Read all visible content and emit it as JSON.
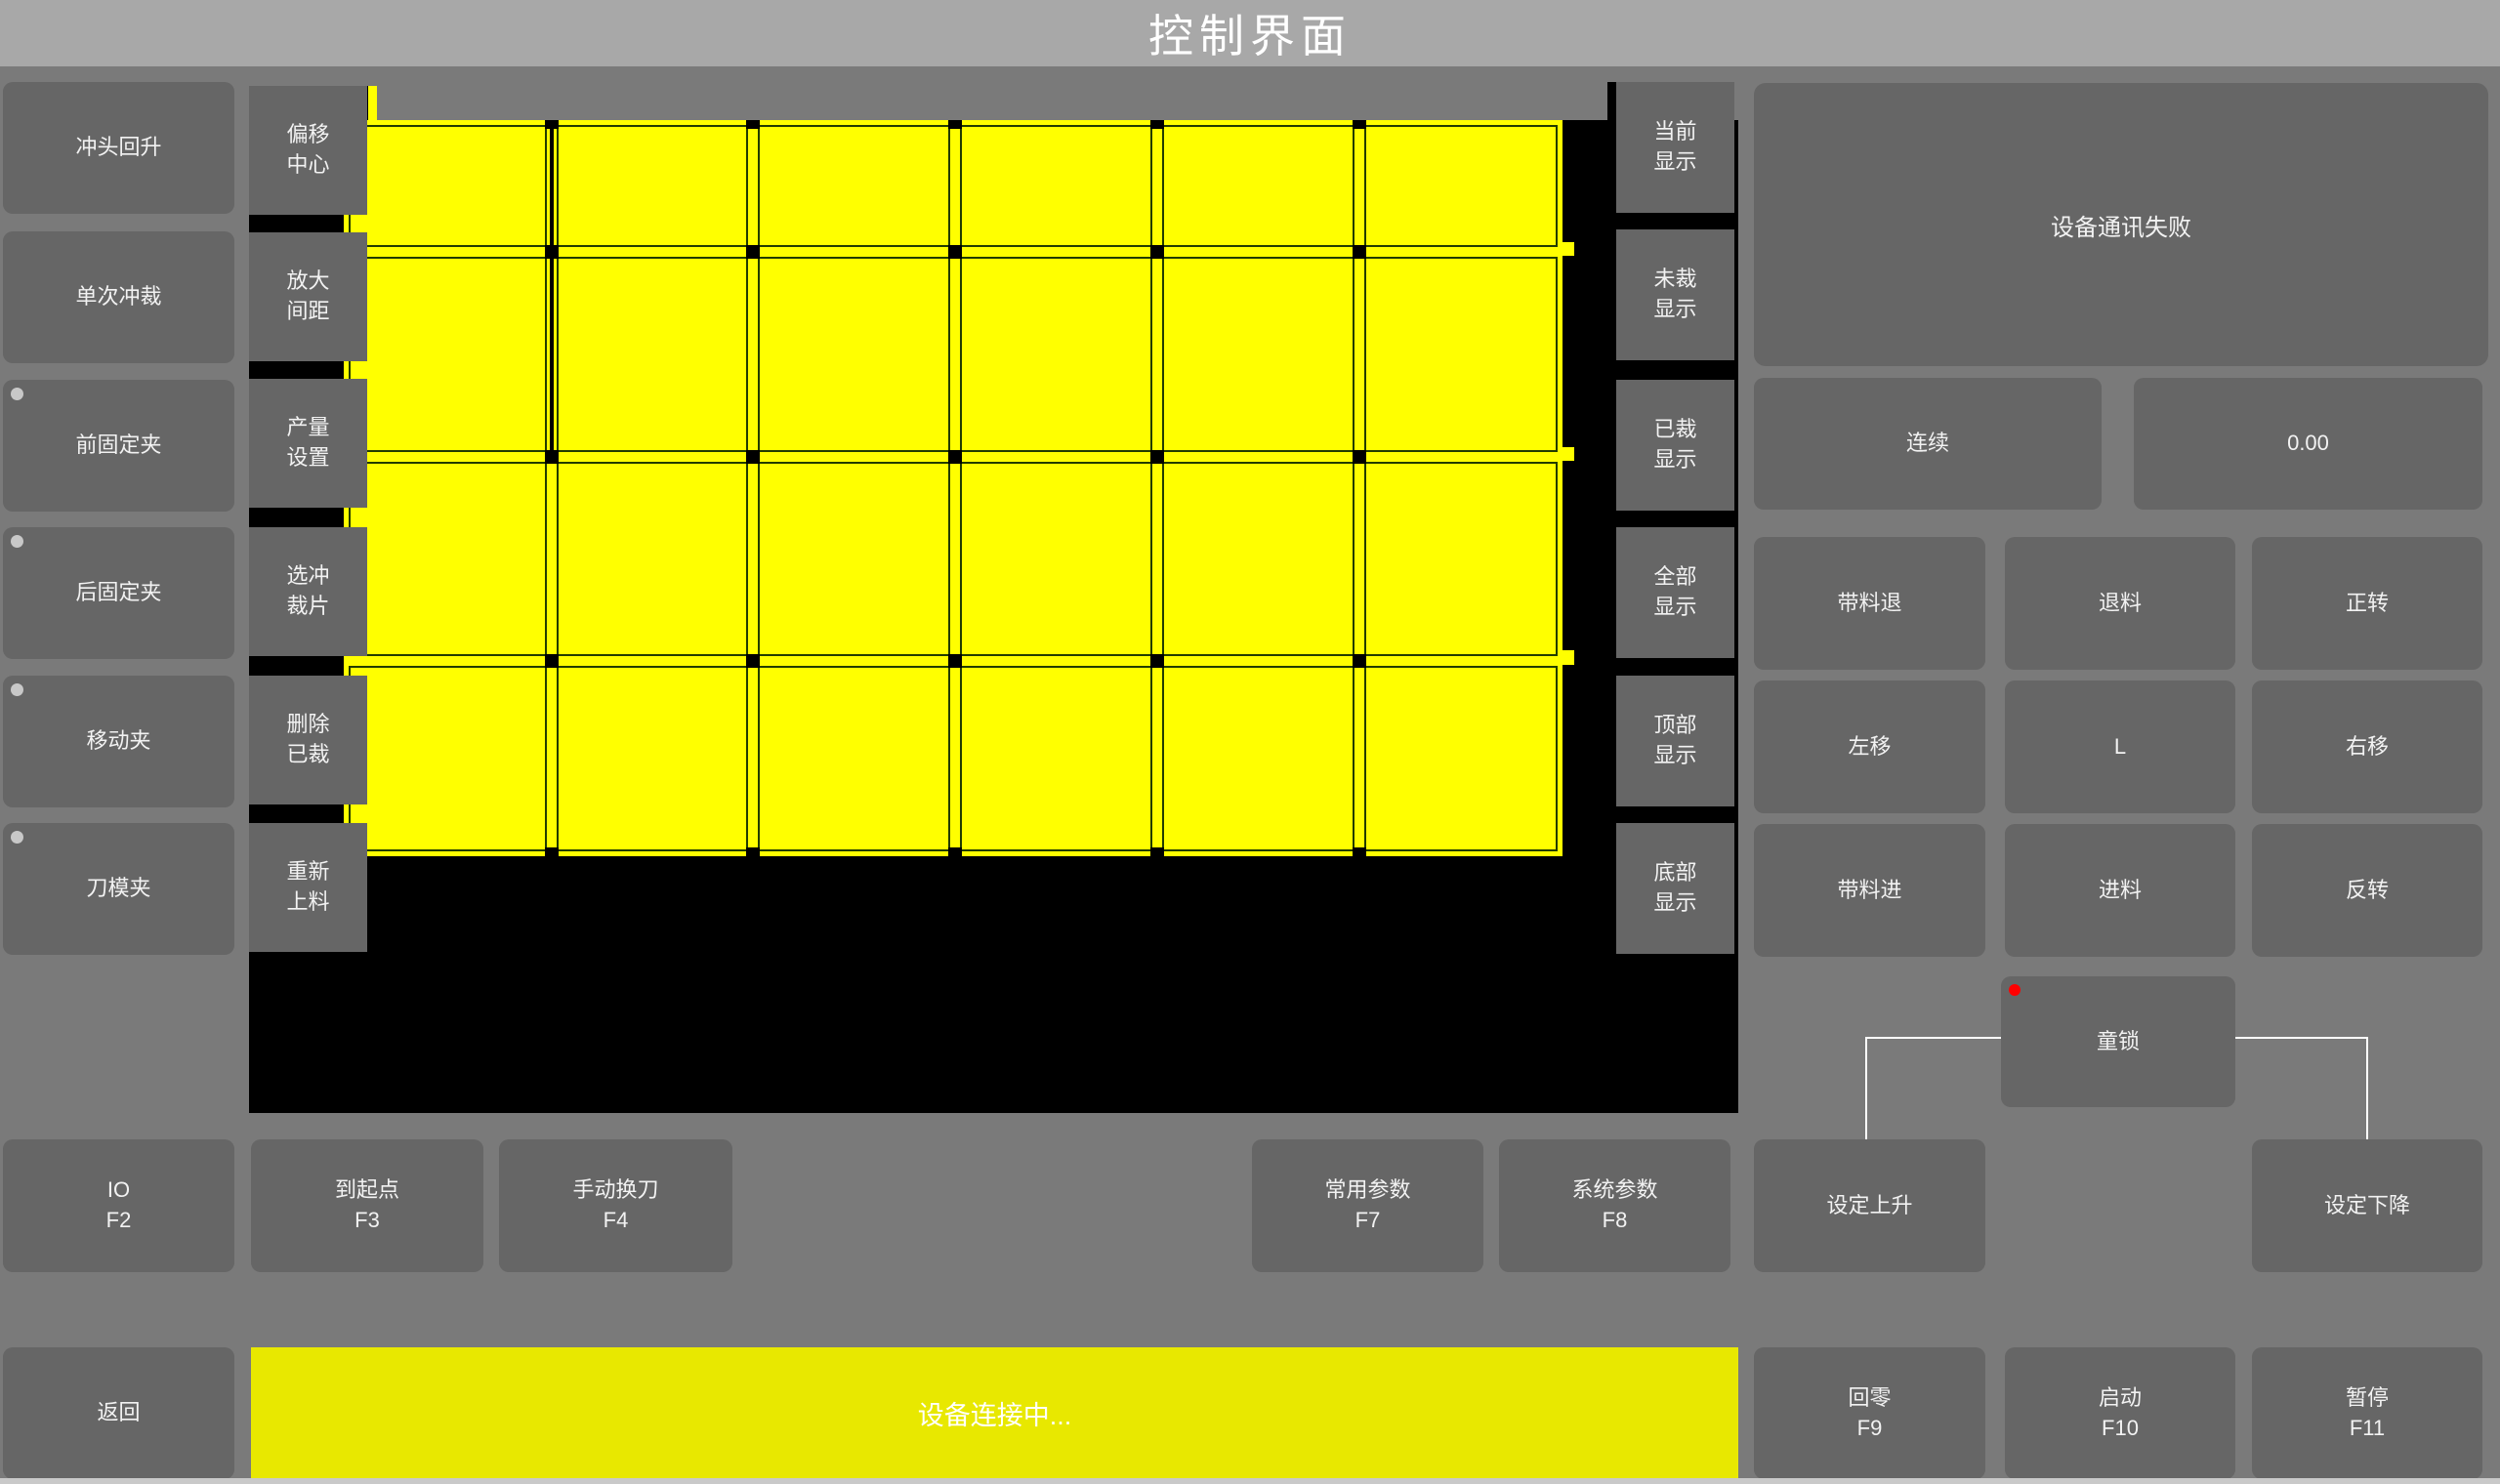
{
  "title": "控制界面",
  "machine_buttons": [
    {
      "name": "punch-up",
      "label": "冲头回升",
      "indicator": false
    },
    {
      "name": "single-punch",
      "label": "单次冲裁",
      "indicator": false
    },
    {
      "name": "front-clamp",
      "label": "前固定夹",
      "indicator": true
    },
    {
      "name": "rear-clamp",
      "label": "后固定夹",
      "indicator": true
    },
    {
      "name": "moving-clamp",
      "label": "移动夹",
      "indicator": true
    },
    {
      "name": "die-clamp",
      "label": "刀模夹",
      "indicator": true
    }
  ],
  "tool_buttons": [
    {
      "name": "offset-center",
      "label": "偏移\n中心"
    },
    {
      "name": "enlarge-spacing",
      "label": "放大\n间距"
    },
    {
      "name": "output-settings",
      "label": "产量\n设置"
    },
    {
      "name": "select-piece",
      "label": "选冲\n裁片"
    },
    {
      "name": "delete-cut",
      "label": "删除\n已裁"
    },
    {
      "name": "reload-material",
      "label": "重新\n上料"
    }
  ],
  "view_buttons": [
    {
      "name": "view-current",
      "label": "当前\n显示"
    },
    {
      "name": "view-uncut",
      "label": "未裁\n显示"
    },
    {
      "name": "view-cut",
      "label": "已裁\n显示"
    },
    {
      "name": "view-all",
      "label": "全部\n显示"
    },
    {
      "name": "view-top",
      "label": "顶部\n显示"
    },
    {
      "name": "view-bottom",
      "label": "底部\n显示"
    }
  ],
  "right_panel": {
    "message": "设备通讯失败",
    "mode_button": "连续",
    "value_display": "0.00",
    "jog_buttons": [
      {
        "name": "feed-back-with-material",
        "label": "带料退"
      },
      {
        "name": "material-back",
        "label": "退料"
      },
      {
        "name": "rotate-forward",
        "label": "正转"
      },
      {
        "name": "move-left",
        "label": "左移"
      },
      {
        "name": "l-key",
        "label": "L"
      },
      {
        "name": "move-right",
        "label": "右移"
      },
      {
        "name": "feed-in-with-material",
        "label": "带料进"
      },
      {
        "name": "material-feed",
        "label": "进料"
      },
      {
        "name": "rotate-reverse",
        "label": "反转"
      }
    ],
    "child_lock": "童锁",
    "set_rise": "设定上升",
    "set_fall": "设定下降"
  },
  "function_keys": [
    {
      "name": "io",
      "label": "IO",
      "key": "F2"
    },
    {
      "name": "to-origin",
      "label": "到起点",
      "key": "F3"
    },
    {
      "name": "manual-tool-change",
      "label": "手动换刀",
      "key": "F4"
    },
    {
      "name": "common-params",
      "label": "常用参数",
      "key": "F7"
    },
    {
      "name": "system-params",
      "label": "系统参数",
      "key": "F8"
    }
  ],
  "bottom_bar": {
    "back": "返回",
    "status": "设备连接中...",
    "function_keys": [
      {
        "name": "home",
        "label": "回零",
        "key": "F9"
      },
      {
        "name": "start",
        "label": "启动",
        "key": "F10"
      },
      {
        "name": "pause",
        "label": "暂停",
        "key": "F11"
      }
    ]
  },
  "pieces_view": {
    "rows": 4,
    "columns": 6,
    "piece_count": 24,
    "piece_color": "#ffff00",
    "outline_color": "#223c00",
    "background_color": "#000000"
  },
  "colors": {
    "page_bg": "#7a7a7a",
    "title_bar_bg": "#a8a8a8",
    "button_bg": "#666666",
    "status_bar_bg": "#e8e800",
    "indicator_off": "#c8c8c8",
    "child_lock_indicator": "#ff0000",
    "connector_line": "#ffffff"
  }
}
